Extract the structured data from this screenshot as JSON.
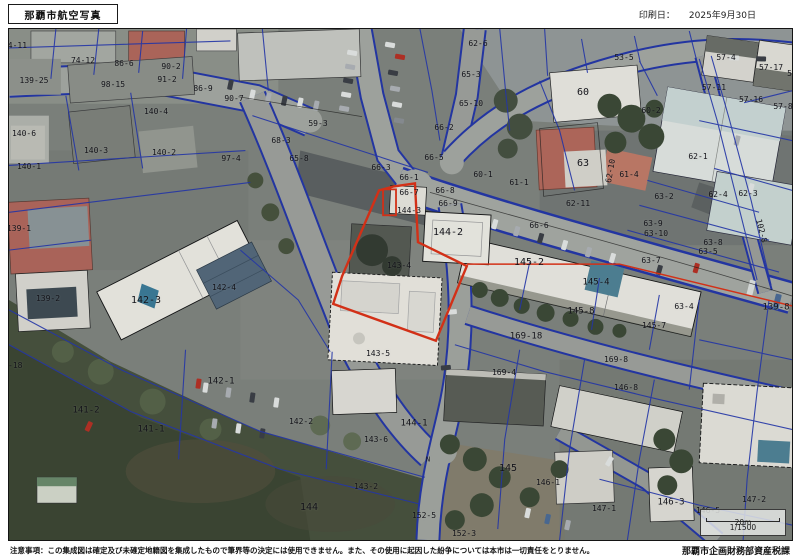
{
  "header": {
    "title": "那覇市航空写真",
    "print_date_label": "印刷日：",
    "print_date": "2025年9月30日"
  },
  "footer": {
    "disclaimer": "注意事項：この集成図は確定及び未確定地籍図を集成したもので筆界等の決定には使用できません。また、その使用に起因した紛争については本市は一切責任をとりません。",
    "attribution": "那覇市企画財務部資産税課"
  },
  "map": {
    "scale_bar": {
      "distance": "20m",
      "ratio": "1/1500"
    },
    "colors": {
      "highlight_red": "#d23017",
      "cadastral_blue": "#2335a6",
      "road_gray": "#a5a8a2",
      "vegetation_green": "#47513c"
    },
    "labels": [
      {
        "t": "74-11",
        "x": 14,
        "y": 45
      },
      {
        "t": "74-12",
        "x": 82,
        "y": 60
      },
      {
        "t": "139-25",
        "x": 33,
        "y": 80
      },
      {
        "t": "86-6",
        "x": 123,
        "y": 63
      },
      {
        "t": "90-2",
        "x": 170,
        "y": 66
      },
      {
        "t": "91-2",
        "x": 166,
        "y": 79
      },
      {
        "t": "98-15",
        "x": 112,
        "y": 84
      },
      {
        "t": "86-9",
        "x": 202,
        "y": 88
      },
      {
        "t": "90-7",
        "x": 233,
        "y": 98
      },
      {
        "t": "140-4",
        "x": 155,
        "y": 111
      },
      {
        "t": "140-6",
        "x": 23,
        "y": 133
      },
      {
        "t": "140-3",
        "x": 95,
        "y": 150
      },
      {
        "t": "140-2",
        "x": 163,
        "y": 152
      },
      {
        "t": "140-1",
        "x": 28,
        "y": 166
      },
      {
        "t": "97-4",
        "x": 230,
        "y": 158
      },
      {
        "t": "59-3",
        "x": 317,
        "y": 123
      },
      {
        "t": "68-3",
        "x": 280,
        "y": 140
      },
      {
        "t": "65-8",
        "x": 298,
        "y": 158
      },
      {
        "t": "62-6",
        "x": 477,
        "y": 43
      },
      {
        "t": "65-3",
        "x": 470,
        "y": 74
      },
      {
        "t": "65-10",
        "x": 470,
        "y": 103
      },
      {
        "t": "66-2",
        "x": 443,
        "y": 127
      },
      {
        "t": "66-5",
        "x": 433,
        "y": 157
      },
      {
        "t": "66-3",
        "x": 380,
        "y": 167
      },
      {
        "t": "66-1",
        "x": 408,
        "y": 177
      },
      {
        "t": "60-1",
        "x": 482,
        "y": 174
      },
      {
        "t": "61-1",
        "x": 518,
        "y": 182
      },
      {
        "t": "66-7",
        "x": 408,
        "y": 192
      },
      {
        "t": "66-8",
        "x": 444,
        "y": 190
      },
      {
        "t": "66-9",
        "x": 447,
        "y": 203
      },
      {
        "t": "66-6",
        "x": 538,
        "y": 225
      },
      {
        "t": "53-5",
        "x": 623,
        "y": 57
      },
      {
        "t": "57-4",
        "x": 725,
        "y": 57
      },
      {
        "t": "57-17",
        "x": 770,
        "y": 67
      },
      {
        "t": "57",
        "x": 791,
        "y": 73
      },
      {
        "t": "60",
        "x": 582,
        "y": 92,
        "s": 10
      },
      {
        "t": "57-11",
        "x": 713,
        "y": 87
      },
      {
        "t": "57-16",
        "x": 750,
        "y": 99
      },
      {
        "t": "57-8",
        "x": 782,
        "y": 106
      },
      {
        "t": "60-2",
        "x": 650,
        "y": 110
      },
      {
        "t": "63",
        "x": 582,
        "y": 163,
        "s": 10
      },
      {
        "t": "62-10",
        "x": 610,
        "y": 170,
        "r": -80
      },
      {
        "t": "61-4",
        "x": 628,
        "y": 174
      },
      {
        "t": "62-11",
        "x": 577,
        "y": 203
      },
      {
        "t": "62-1",
        "x": 697,
        "y": 156
      },
      {
        "t": "63-2",
        "x": 663,
        "y": 196
      },
      {
        "t": "62-4",
        "x": 717,
        "y": 194
      },
      {
        "t": "62-3",
        "x": 747,
        "y": 193
      },
      {
        "t": "63-9",
        "x": 652,
        "y": 223
      },
      {
        "t": "63-10",
        "x": 655,
        "y": 233
      },
      {
        "t": "63-8",
        "x": 712,
        "y": 242
      },
      {
        "t": "63-5",
        "x": 707,
        "y": 251
      },
      {
        "t": "63-7",
        "x": 650,
        "y": 260
      },
      {
        "t": "102-8",
        "x": 760,
        "y": 230,
        "r": 75
      },
      {
        "t": "139-8",
        "x": 775,
        "y": 307,
        "s": 9
      },
      {
        "t": "63-4",
        "x": 683,
        "y": 306
      },
      {
        "t": "144-3",
        "x": 408,
        "y": 210
      },
      {
        "t": "144-2",
        "x": 447,
        "y": 232,
        "s": 10
      },
      {
        "t": "143-4",
        "x": 398,
        "y": 265
      },
      {
        "t": "143-5",
        "x": 377,
        "y": 353
      },
      {
        "t": "142-4",
        "x": 223,
        "y": 287
      },
      {
        "t": "142-3",
        "x": 145,
        "y": 300,
        "s": 10
      },
      {
        "t": "139-1",
        "x": 18,
        "y": 228
      },
      {
        "t": "139-2",
        "x": 47,
        "y": 298
      },
      {
        "t": "139-18",
        "x": 7,
        "y": 365
      },
      {
        "t": "145-2",
        "x": 528,
        "y": 262,
        "s": 10
      },
      {
        "t": "145-4",
        "x": 595,
        "y": 282,
        "s": 9
      },
      {
        "t": "145-8",
        "x": 580,
        "y": 311,
        "s": 9
      },
      {
        "t": "145-7",
        "x": 653,
        "y": 325
      },
      {
        "t": "169-18",
        "x": 525,
        "y": 336,
        "s": 9
      },
      {
        "t": "169-8",
        "x": 615,
        "y": 359
      },
      {
        "t": "169-4",
        "x": 503,
        "y": 372
      },
      {
        "t": "141-2",
        "x": 85,
        "y": 410,
        "s": 9
      },
      {
        "t": "141-1",
        "x": 150,
        "y": 429,
        "s": 9
      },
      {
        "t": "142-1",
        "x": 220,
        "y": 381,
        "s": 9
      },
      {
        "t": "142-2",
        "x": 300,
        "y": 421
      },
      {
        "t": "144-1",
        "x": 413,
        "y": 423,
        "s": 9
      },
      {
        "t": "143-6",
        "x": 375,
        "y": 439
      },
      {
        "t": "144",
        "x": 308,
        "y": 507,
        "s": 10
      },
      {
        "t": "143-2",
        "x": 365,
        "y": 486
      },
      {
        "t": "152-5",
        "x": 423,
        "y": 515
      },
      {
        "t": "152-3",
        "x": 463,
        "y": 533
      },
      {
        "t": "145",
        "x": 507,
        "y": 468,
        "s": 10
      },
      {
        "t": "146-1",
        "x": 547,
        "y": 482
      },
      {
        "t": "146-8",
        "x": 625,
        "y": 387
      },
      {
        "t": "146-3",
        "x": 670,
        "y": 502,
        "s": 9
      },
      {
        "t": "146-5",
        "x": 707,
        "y": 510
      },
      {
        "t": "147-2",
        "x": 753,
        "y": 499
      },
      {
        "t": "147-1",
        "x": 603,
        "y": 508
      },
      {
        "t": "N",
        "x": 427,
        "y": 459,
        "s": 7
      }
    ]
  }
}
